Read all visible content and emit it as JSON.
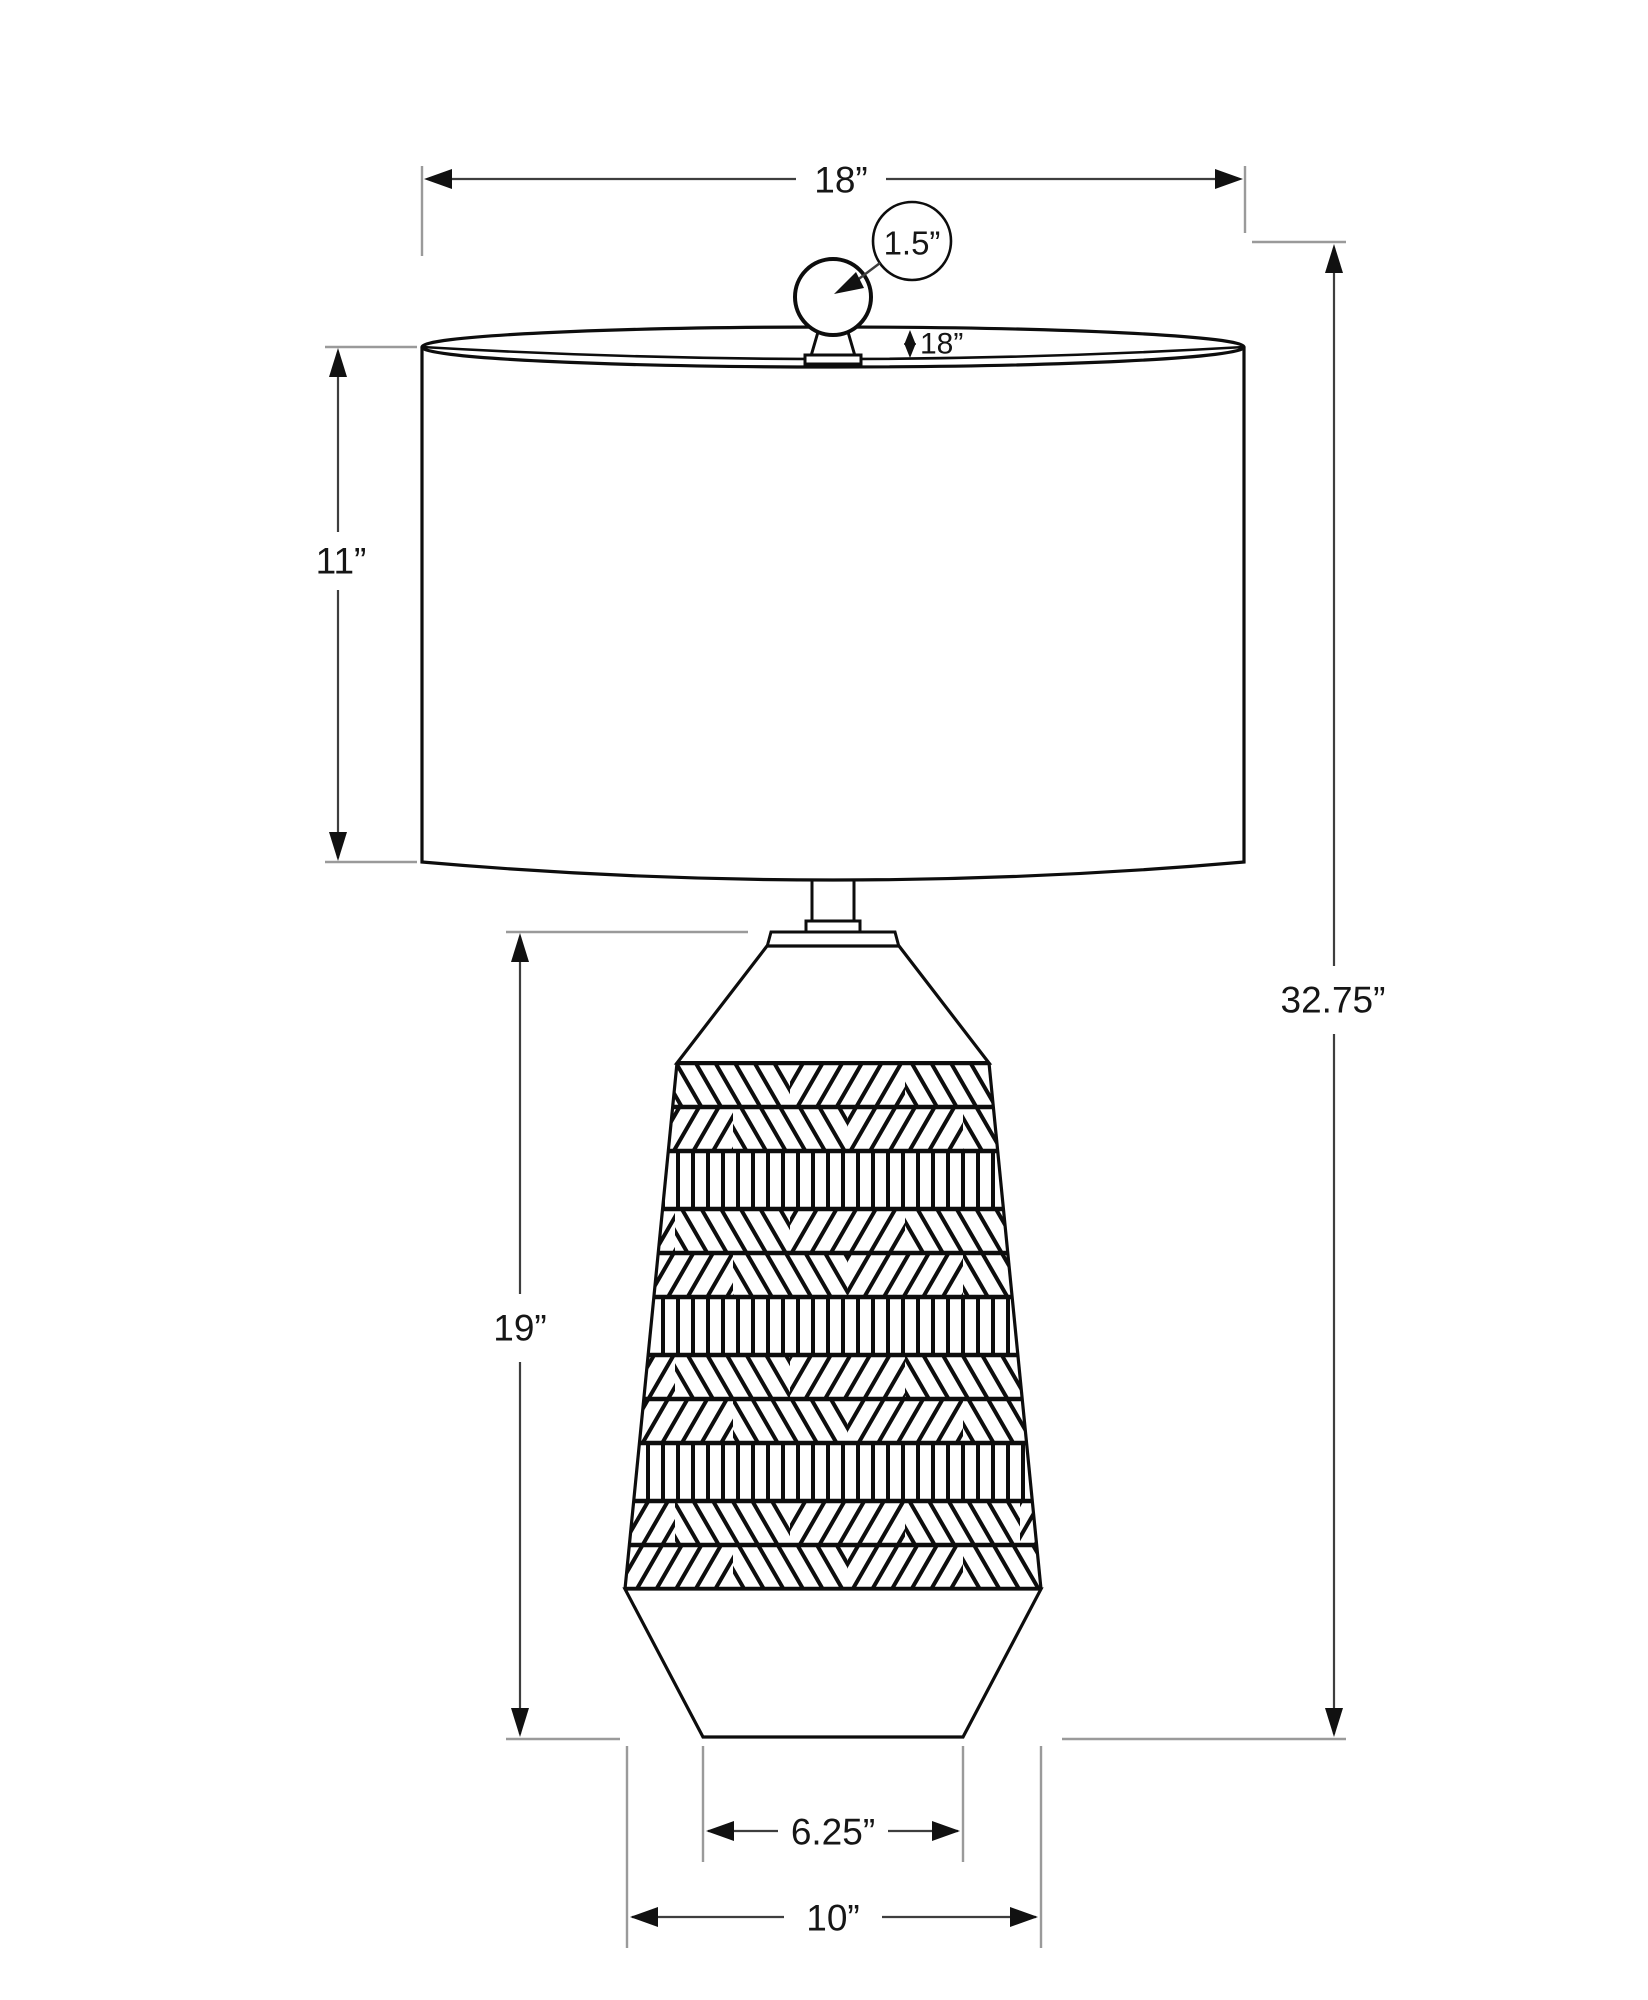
{
  "diagram_title": "Table lamp dimension drawing",
  "colors": {
    "artwork_stroke": "#0d0d0d",
    "dimension_line": "#3e3e3e",
    "extension_line": "#9a9a9a",
    "background": "#ffffff"
  },
  "labels": {
    "shade_width": "18”",
    "finial_diameter": "1.5”",
    "rim_depth": "18”",
    "shade_height": "11”",
    "overall_height": "32.75”",
    "body_height": "19”",
    "base_inner_width": "6.25”",
    "base_outer_width": "10”"
  }
}
